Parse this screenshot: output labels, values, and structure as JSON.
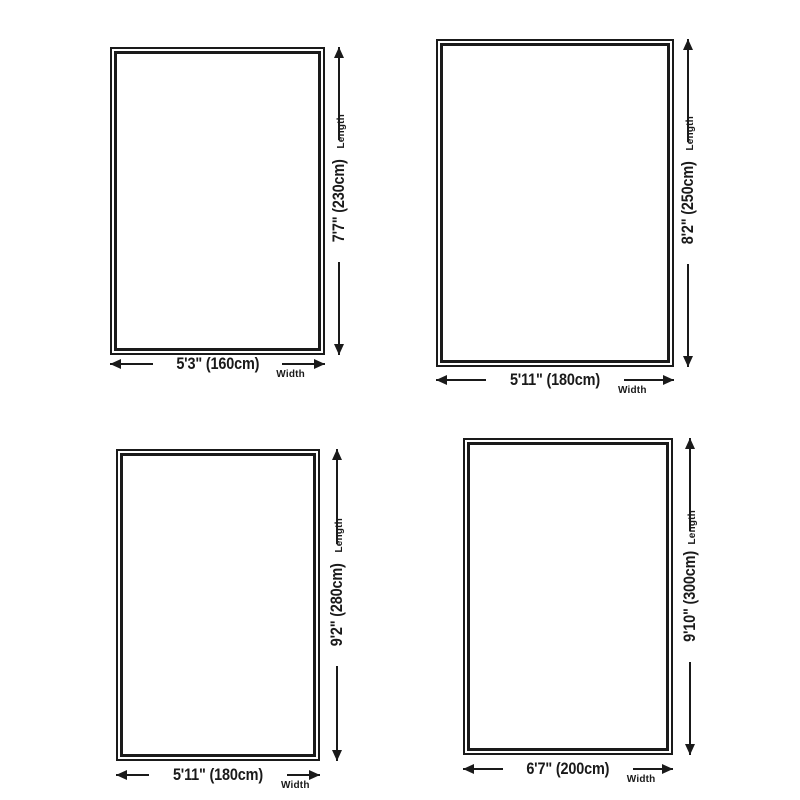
{
  "theme": {
    "ink": "#1a1a1a",
    "background": "#ffffff"
  },
  "labels": {
    "length": "Length",
    "width": "Width"
  },
  "rugs": [
    {
      "name": "rug-160x230",
      "width_label": "5'3\" (160cm)",
      "length_label": "7'7\" (230cm)",
      "width_cm": 160,
      "length_cm": 230
    },
    {
      "name": "rug-180x250",
      "width_label": "5'11\" (180cm)",
      "length_label": "8'2\" (250cm)",
      "width_cm": 180,
      "length_cm": 250
    },
    {
      "name": "rug-180x280",
      "width_label": "5'11\" (180cm)",
      "length_label": "9'2\" (280cm)",
      "width_cm": 180,
      "length_cm": 280
    },
    {
      "name": "rug-200x300",
      "width_label": "6'7\" (200cm)",
      "length_label": "9'10\" (300cm)",
      "width_cm": 200,
      "length_cm": 300
    }
  ]
}
